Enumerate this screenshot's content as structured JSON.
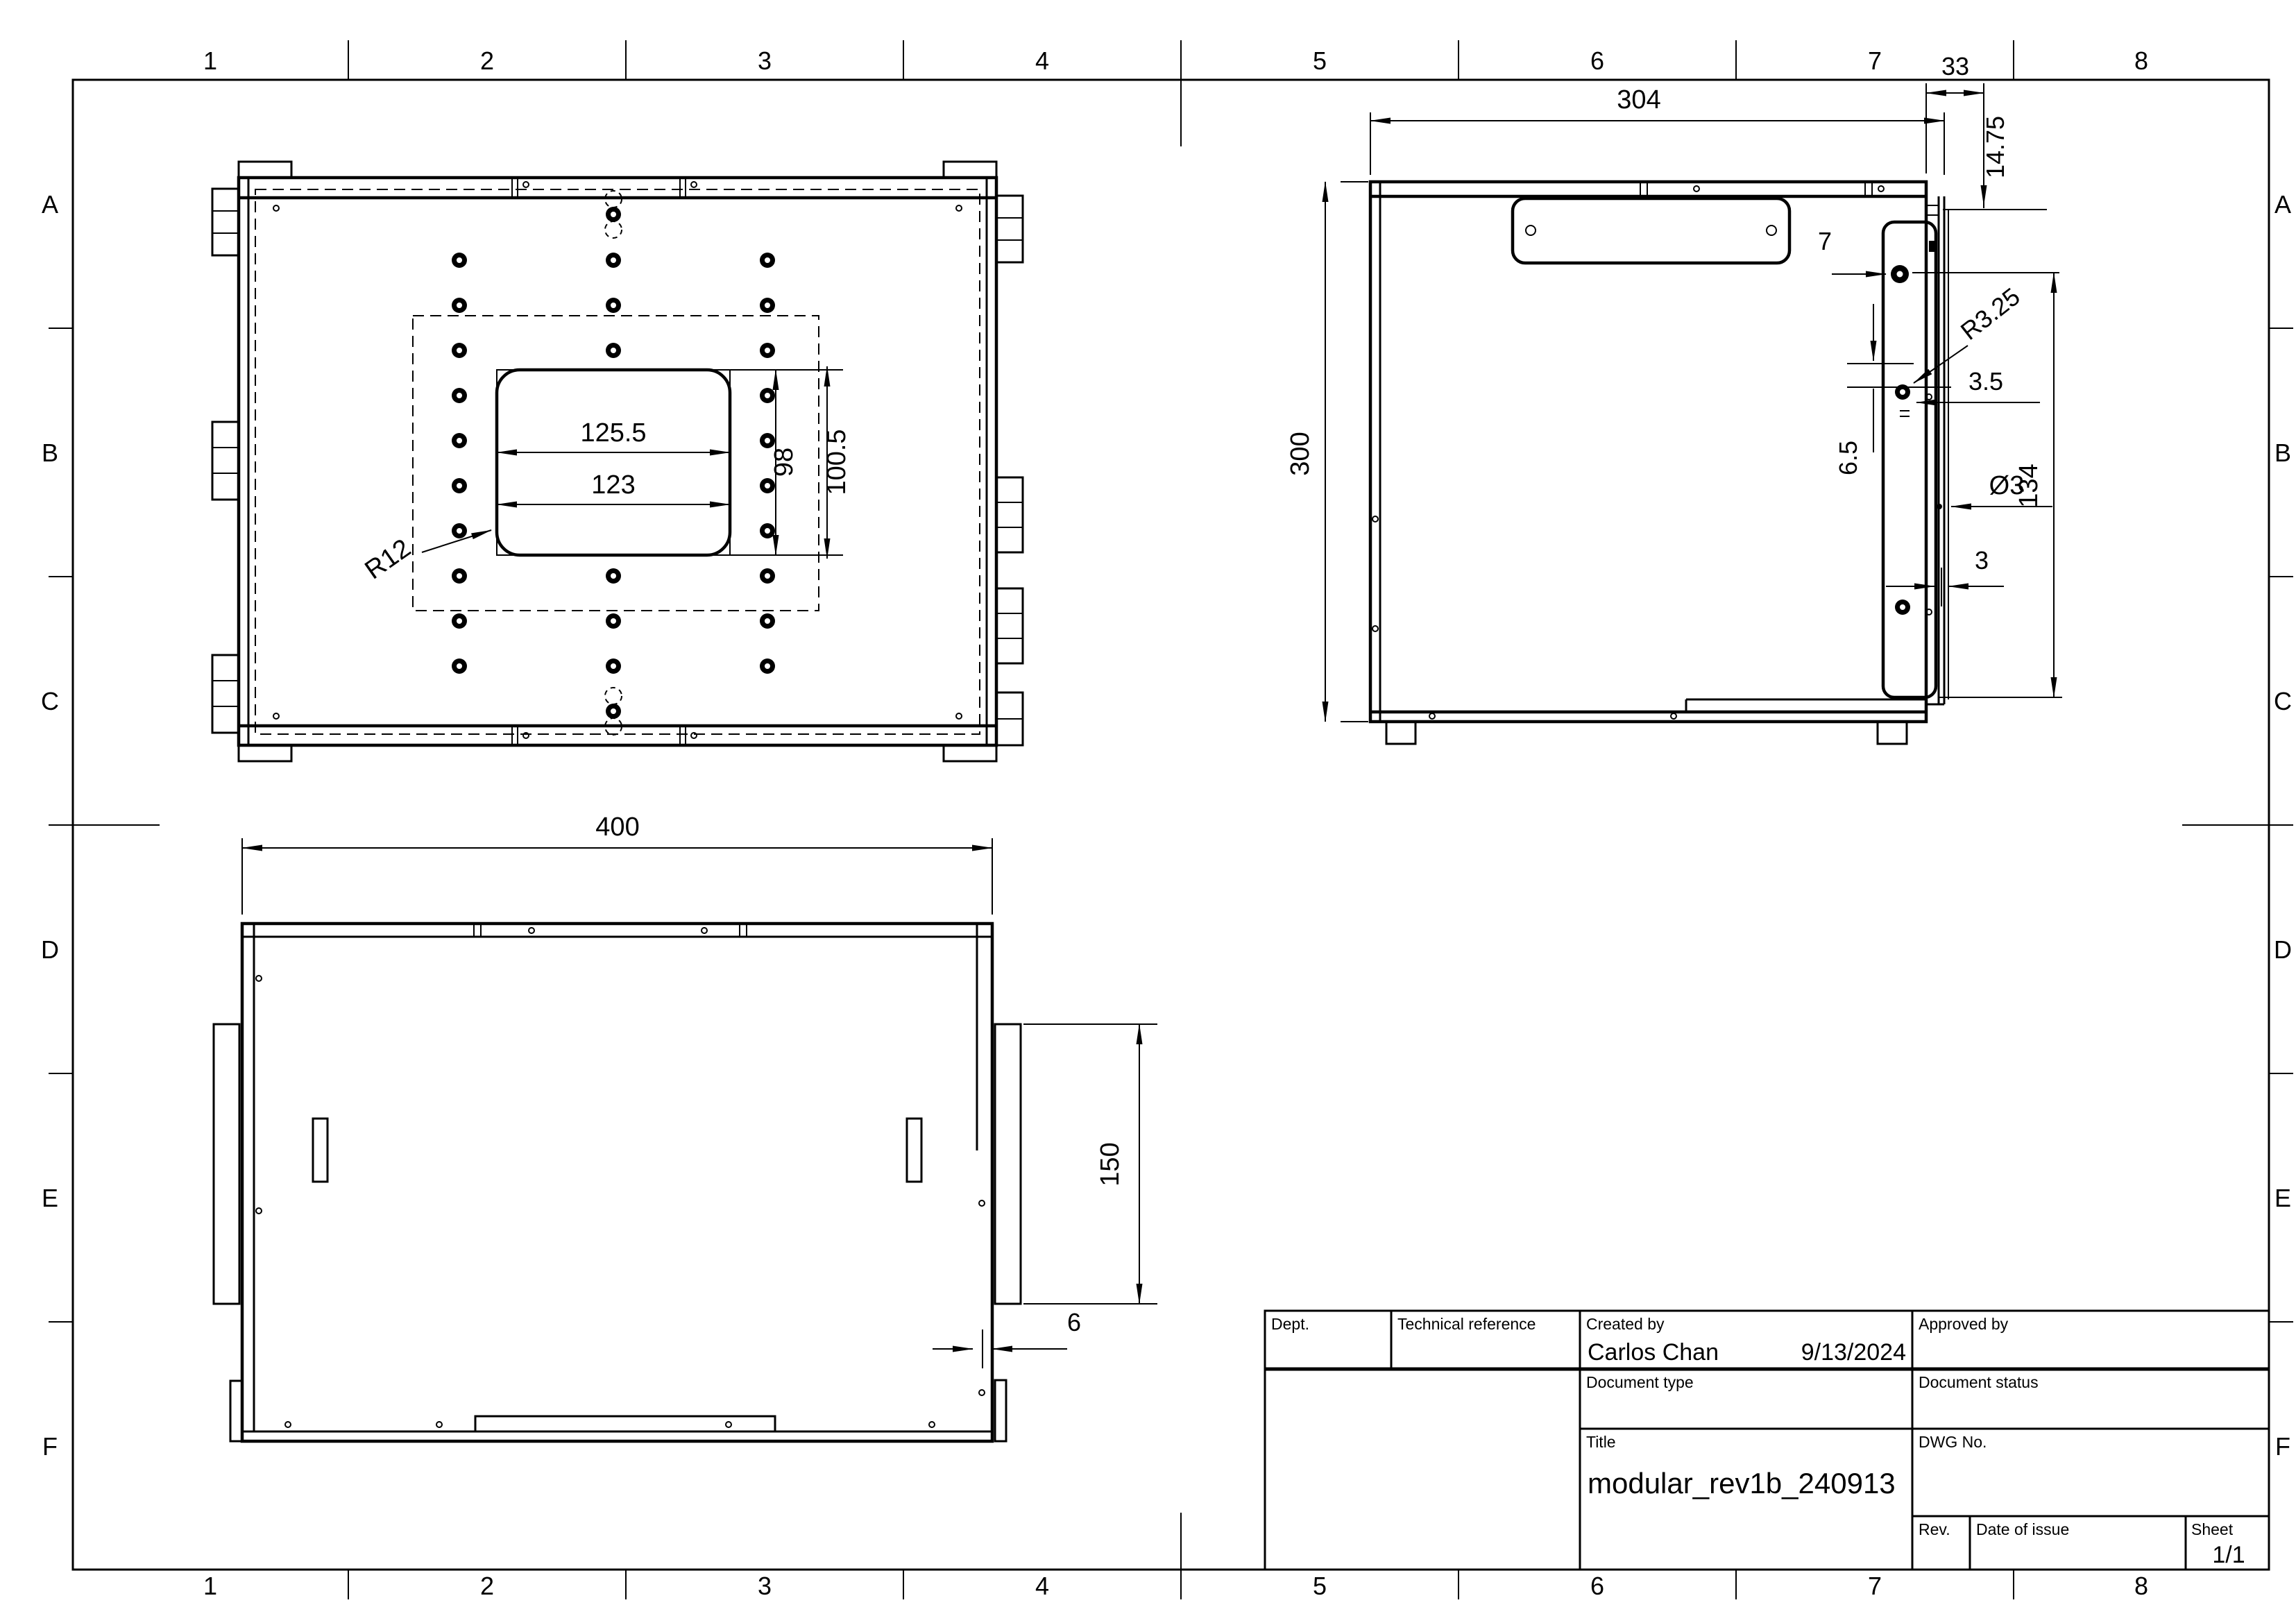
{
  "sheet": {
    "columns": [
      "1",
      "2",
      "3",
      "4",
      "5",
      "6",
      "7",
      "8"
    ],
    "rows": [
      "A",
      "B",
      "C",
      "D",
      "E",
      "F"
    ],
    "line_color": "#000000",
    "background_color": "#ffffff"
  },
  "title_block": {
    "dept_label": "Dept.",
    "tech_ref_label": "Technical reference",
    "created_by_label": "Created by",
    "created_by_value": "Carlos Chan",
    "created_date": "9/13/2024",
    "approved_by_label": "Approved by",
    "doc_type_label": "Document type",
    "doc_status_label": "Document status",
    "title_label": "Title",
    "title_value": "modular_rev1b_240913",
    "dwg_no_label": "DWG No.",
    "rev_label": "Rev.",
    "date_of_issue_label": "Date of issue",
    "sheet_label": "Sheet",
    "sheet_value": "1/1"
  },
  "views": {
    "top_view": {
      "dims": {
        "opening_width": "125.5",
        "panel_width": "123",
        "panel_height": "98",
        "opening_height": "100.5",
        "corner_radius": "R12"
      }
    },
    "side_view": {
      "dims": {
        "body_width": "304",
        "plate_offset": "33",
        "plate_inset": "14.75",
        "body_height": "300",
        "hole_edge_offset": "7",
        "slot_radius": "R3.25",
        "hole_gap": "3.5",
        "hole_pitch": "6.5",
        "plate_length": "134",
        "hole_diameter": "Ø3",
        "panel_thickness": "3"
      }
    },
    "front_view": {
      "dims": {
        "body_width": "400",
        "tab_length": "150",
        "wall_thickness": "6"
      }
    }
  }
}
